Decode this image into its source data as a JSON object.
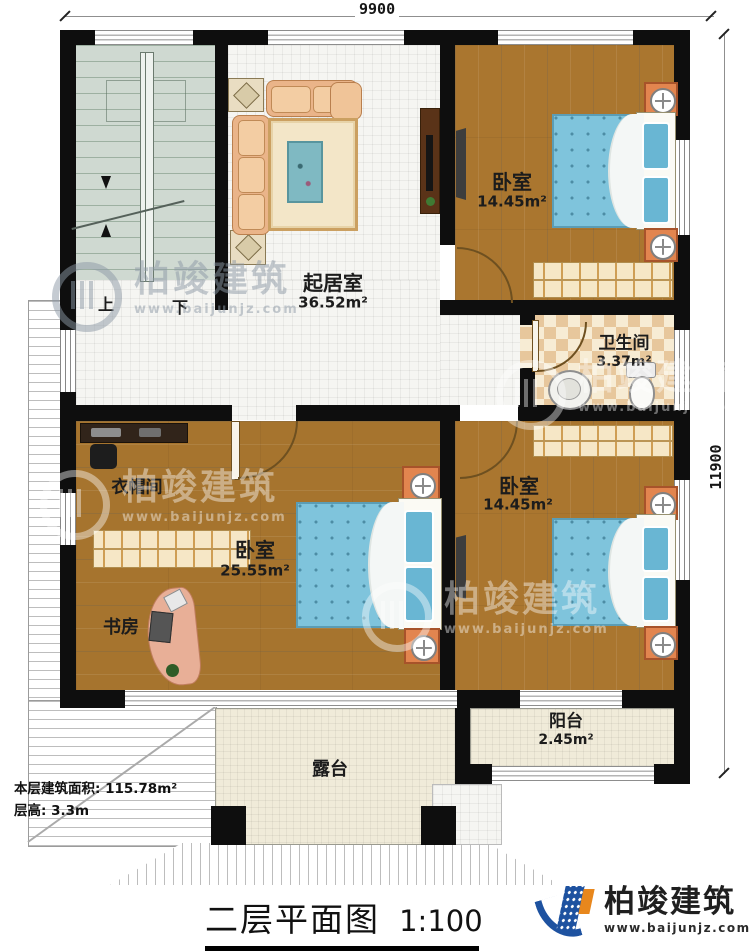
{
  "plan": {
    "dimensions": {
      "width_label": "9900",
      "height_label": "11900"
    },
    "stairs": {
      "up": "上",
      "down": "下"
    },
    "rooms": {
      "living_room": {
        "name": "起居室",
        "area": "36.52m²"
      },
      "bedroom_top": {
        "name": "卧室",
        "area": "14.45m²"
      },
      "bedroom_right": {
        "name": "卧室",
        "area": "14.45m²"
      },
      "bedroom_master": {
        "name": "卧室",
        "area": "25.55m²"
      },
      "bathroom": {
        "name": "卫生间",
        "area": "3.37m²"
      },
      "cloakroom": {
        "name": "衣帽间"
      },
      "study": {
        "name": "书房"
      },
      "balcony": {
        "name": "阳台",
        "area": "2.45m²"
      },
      "terrace": {
        "name": "露台"
      }
    },
    "notes": {
      "floor_area_label": "本层建筑面积: 115.78m²",
      "floor_height_label": "层高: 3.3m"
    },
    "title": {
      "name": "二层平面图",
      "scale": "1:100"
    }
  },
  "branding": {
    "logo_text": "柏竣建筑",
    "logo_url": "www.baijunjz.com",
    "watermark_text": "柏竣建筑",
    "watermark_url": "www.baijunjz.com"
  },
  "colors": {
    "wall": "#0e0e0e",
    "wood_floor": "#aa762f",
    "stair_floor": "#cfd9d1",
    "mattress_blue": "#7fc4dc",
    "nightstand_orange": "#e2854f",
    "logo_blue": "#1e52a0",
    "logo_orange": "#e8871d"
  }
}
